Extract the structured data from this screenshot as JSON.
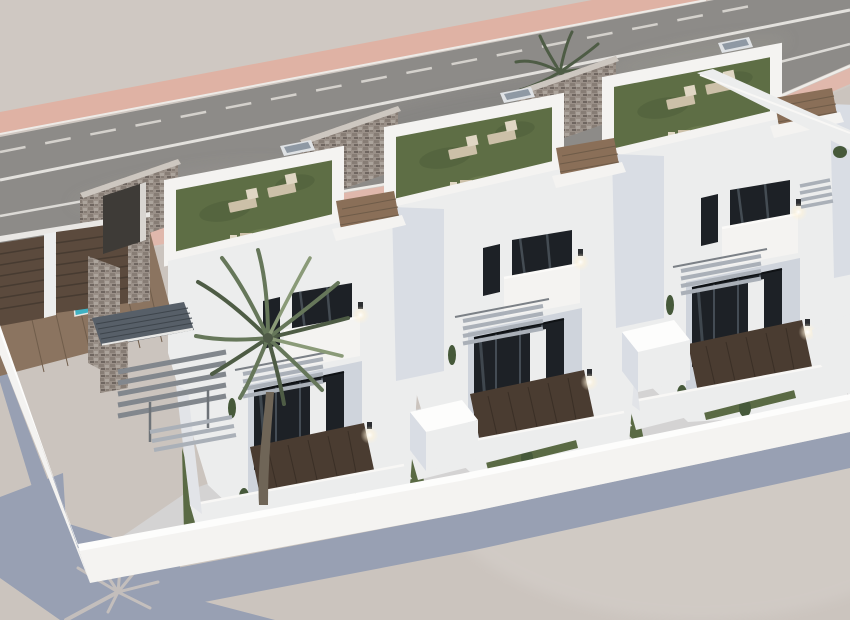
{
  "scene": {
    "type": "3d-architectural-exterior-render",
    "description": "Aerial 3D render of a row of three modern white two-storey townhouses with rooftop solarium terraces, stone feature walls, private courtyards, a small pool, a tall palm tree and a white perimeter wall beside an asphalt road with a pink sidewalk",
    "view": "high oblique bird's-eye view",
    "lighting": "daylight, sun from upper right, long blue-grey shadows cast to lower left"
  },
  "objects": {
    "road": {
      "surface": "asphalt",
      "markings": [
        "dashed-lane-line",
        "solid-lane-line",
        "edge-line"
      ],
      "far_sidewalk": "pink",
      "near_sidewalk": "pink"
    },
    "houses": [
      {
        "id": "house-1",
        "features": [
          "stone-feature-tower",
          "rooftop-terrace-with-turf",
          "sun-loungers",
          "balcony",
          "external-stairs",
          "pergola",
          "slate-canopy",
          "courtyard-deck",
          "palm-tree",
          "pool",
          "timber-street-gates",
          "wall-lamps",
          "roof-skylight"
        ]
      },
      {
        "id": "house-2",
        "features": [
          "stone-divider-wall",
          "rooftop-terrace-with-turf",
          "sun-loungers",
          "balcony",
          "external-stairs",
          "courtyard-deck",
          "entrance-gate-box",
          "wall-lamps",
          "roof-skylight"
        ]
      },
      {
        "id": "house-3",
        "features": [
          "stone-divider-wall",
          "rooftop-terrace-with-turf",
          "sun-loungers",
          "balcony",
          "external-stairs",
          "courtyard-deck",
          "entrance-gate-box",
          "wall-lamps",
          "roof-skylight"
        ]
      }
    ],
    "site": [
      "white-perimeter-wall",
      "front-gate-boxes",
      "ground-shadow",
      "palm-shadow-silhouette",
      "background-palm"
    ]
  },
  "palette": {
    "bg": "#cfc8c2",
    "pink": "#dfb2a4",
    "pink2": "#e0b8ac",
    "road": "#8d8b88",
    "ground": "#cbc4be",
    "shadow": "#98a0b3",
    "wall_bright": "#f4f3f1",
    "wall_light": "#eceded",
    "wall_mid": "#e2e4e8",
    "wall_shade": "#d9dde4",
    "wall_shade2": "#cfd4dc",
    "turf": "#5e6e45",
    "turf_dark": "#4f5e3a",
    "turf_light": "#728153",
    "turf2": "#5a6a44",
    "wood": "#8a6f58",
    "wood2": "#8b7460",
    "deck": "#4a3c31",
    "pool": "#3fb1c2",
    "gate": "#5b4a3d",
    "glass": "#1d2126",
    "plant": "#46593a",
    "trunk": "#6f6557",
    "palm_dark": "#4e5c45",
    "palm_mid": "#66775a",
    "palm_light": "#8a9a78",
    "step": "#aab0b8",
    "beam": "#82878d",
    "roofslate": "#575f68",
    "stone_base": "#9a9088",
    "stone_a": "#877d75",
    "stone_b": "#aca49c",
    "stone_c": "#6f6660",
    "cap_white": "#fdfdfc",
    "lounger": "#ccc0a8",
    "lounger_light": "#e0d7c4",
    "lamp_glow": "#fff3d8"
  }
}
